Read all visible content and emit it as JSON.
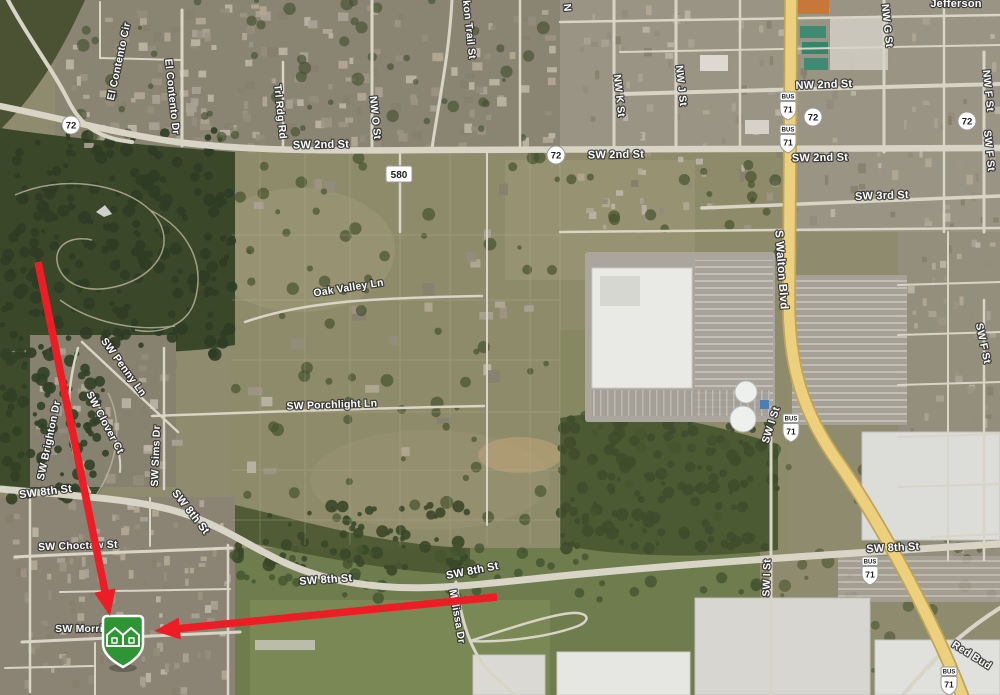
{
  "map_view": {
    "type": "satellite-map",
    "description": "Aerial satellite map with road labels, highway route shields, a green two-house property marker near SW Morris, and two red annotation arrows pointing to the marker"
  },
  "road_labels": [
    {
      "text": "El Contento Cir",
      "x": 122,
      "y": 62,
      "r": -78,
      "s": 10.5
    },
    {
      "text": "El Contento Dr",
      "x": 169,
      "y": 97,
      "r": 84,
      "s": 10.5
    },
    {
      "text": "Trl Rdg Rd",
      "x": 277,
      "y": 112,
      "r": 84,
      "s": 10.5
    },
    {
      "text": "kon Trail St",
      "x": 466,
      "y": 30,
      "r": 84,
      "s": 10.5
    },
    {
      "text": "NW O St",
      "x": 372,
      "y": 118,
      "r": 84,
      "s": 10.5
    },
    {
      "text": "N",
      "x": 564,
      "y": 8,
      "r": 84,
      "s": 10.5
    },
    {
      "text": "NW K St",
      "x": 616,
      "y": 96,
      "r": 84,
      "s": 10.5
    },
    {
      "text": "NW J St",
      "x": 678,
      "y": 86,
      "r": 84,
      "s": 10.5
    },
    {
      "text": "NW G St",
      "x": 884,
      "y": 26,
      "r": 84,
      "s": 10.5
    },
    {
      "text": "Jefferson",
      "x": 956,
      "y": 7,
      "r": 0,
      "s": 11
    },
    {
      "text": "NW F St",
      "x": 985,
      "y": 91,
      "r": 84,
      "s": 10.5
    },
    {
      "text": "SW F St",
      "x": 986,
      "y": 151,
      "r": 84,
      "s": 10.5
    },
    {
      "text": "NW 2nd St",
      "x": 824,
      "y": 88,
      "r": -2,
      "s": 11
    },
    {
      "text": "SW 2nd St",
      "x": 321,
      "y": 148,
      "r": -1,
      "s": 11
    },
    {
      "text": "SW 2nd St",
      "x": 616,
      "y": 158,
      "r": -1,
      "s": 11
    },
    {
      "text": "SW 2nd St",
      "x": 820,
      "y": 161,
      "r": -1,
      "s": 11
    },
    {
      "text": "SW 3rd St",
      "x": 882,
      "y": 199,
      "r": -2,
      "s": 11
    },
    {
      "text": "S Walton Blvd",
      "x": 778,
      "y": 270,
      "r": 86,
      "s": 11.5
    },
    {
      "text": "Oak Valley Ln",
      "x": 349,
      "y": 291,
      "r": -9,
      "s": 10.5
    },
    {
      "text": "SW Porchlight Ln",
      "x": 332,
      "y": 408,
      "r": -2,
      "s": 10.5
    },
    {
      "text": "SW Penny Ln",
      "x": 121,
      "y": 369,
      "r": 54,
      "s": 10.5
    },
    {
      "text": "SW Clover Ct",
      "x": 102,
      "y": 424,
      "r": 62,
      "s": 10.5
    },
    {
      "text": "SW Brighton Dr",
      "x": 52,
      "y": 441,
      "r": -78,
      "s": 10.5
    },
    {
      "text": "SW Sims Dr",
      "x": 159,
      "y": 456,
      "r": -88,
      "s": 10.5
    },
    {
      "text": "SW F St",
      "x": 980,
      "y": 344,
      "r": 78,
      "s": 10.5
    },
    {
      "text": "SW I St",
      "x": 774,
      "y": 426,
      "r": -72,
      "s": 10.5
    },
    {
      "text": "SW I St",
      "x": 770,
      "y": 578,
      "r": -88,
      "s": 10.5
    },
    {
      "text": "SW 8th St",
      "x": 46,
      "y": 495,
      "r": -7,
      "s": 11
    },
    {
      "text": "SW 8th St",
      "x": 188,
      "y": 514,
      "r": 52,
      "s": 11
    },
    {
      "text": "SW 8th St",
      "x": 326,
      "y": 583,
      "r": -4,
      "s": 11
    },
    {
      "text": "SW 8th St",
      "x": 473,
      "y": 574,
      "r": -11,
      "s": 11
    },
    {
      "text": "SW 8th St",
      "x": 893,
      "y": 551,
      "r": -3,
      "s": 11
    },
    {
      "text": "SW Choctaw St",
      "x": 78,
      "y": 549,
      "r": -2,
      "s": 10.5
    },
    {
      "text": "SW Morris",
      "x": 82,
      "y": 632,
      "r": 0,
      "s": 10.5
    },
    {
      "text": "Melissa Dr",
      "x": 454,
      "y": 617,
      "r": 80,
      "s": 10.5
    },
    {
      "text": "Red Bud",
      "x": 970,
      "y": 658,
      "r": 32,
      "s": 10.5
    }
  ],
  "route_shields": {
    "circles": [
      {
        "num": "72",
        "x": 71,
        "y": 125
      },
      {
        "num": "72",
        "x": 556,
        "y": 155
      },
      {
        "num": "72",
        "x": 813,
        "y": 117
      },
      {
        "num": "72",
        "x": 967,
        "y": 121
      }
    ],
    "boxes": [
      {
        "num": "580",
        "x": 399,
        "y": 174
      }
    ],
    "us_bus": [
      {
        "banner": "BUS",
        "num": "71",
        "x": 788,
        "y": 107
      },
      {
        "banner": "BUS",
        "num": "71",
        "x": 788,
        "y": 140
      },
      {
        "banner": "BUS",
        "num": "71",
        "x": 791,
        "y": 429
      },
      {
        "banner": "BUS",
        "num": "71",
        "x": 870,
        "y": 572
      },
      {
        "banner": "BUS",
        "num": "71",
        "x": 949,
        "y": 682
      }
    ]
  },
  "marker": {
    "kind": "two-houses-pin",
    "x": 123,
    "y": 643,
    "color": "#2e9434"
  },
  "arrows": [
    {
      "x1": 38,
      "y1": 262,
      "x2": 110,
      "y2": 616
    },
    {
      "x1": 497,
      "y1": 597,
      "x2": 154,
      "y2": 631
    }
  ],
  "colors": {
    "arrow_red": "#ee1d25",
    "highway_yellow": "#ecd07e",
    "highway_casing": "#c0a458",
    "road_gray": "#d8d4c6",
    "forest_green": "#3a4729",
    "marker_green": "#2e9434",
    "label_fill": "#ffffff"
  }
}
